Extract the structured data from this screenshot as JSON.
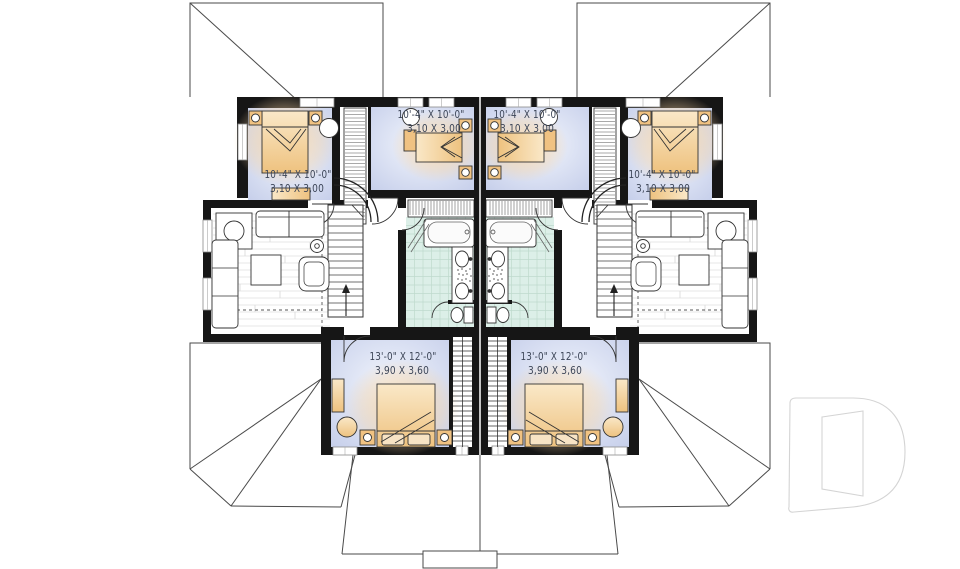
{
  "plan": {
    "type": "floor-plan",
    "rooms": [
      {
        "name": "bedroom-upper-left",
        "imperial": "10'-4\" X 10'-0\"",
        "metric": "3,10 X 3,00"
      },
      {
        "name": "bedroom-upper-middle-left",
        "imperial": "10'-4\" X 10'-0\"",
        "metric": "3,10 X 3,00"
      },
      {
        "name": "bedroom-upper-middle-right",
        "imperial": "10'-4\" X 10'-0\"",
        "metric": "3,10 X 3,00"
      },
      {
        "name": "bedroom-upper-right",
        "imperial": "10'-4\" X 10'-0\"",
        "metric": "3,10 X 3,00"
      },
      {
        "name": "bedroom-lower-left",
        "imperial": "13'-0\" X 12'-0\"",
        "metric": "3,90 X 3,60"
      },
      {
        "name": "bedroom-lower-right",
        "imperial": "13'-0\" X 12'-0\"",
        "metric": "3,90 X 3,60"
      }
    ],
    "colors": {
      "wall": "#161616",
      "bedroom_floor": "#c9d2ec",
      "bath_tile": "#dcefe8",
      "furniture_wood": "#f0c282",
      "label_text": "#3c4557",
      "roof_line": "#4a4a4a",
      "logo_outline": "#d4d4d4"
    },
    "logo": {
      "name": "drummond-d-logo"
    }
  }
}
